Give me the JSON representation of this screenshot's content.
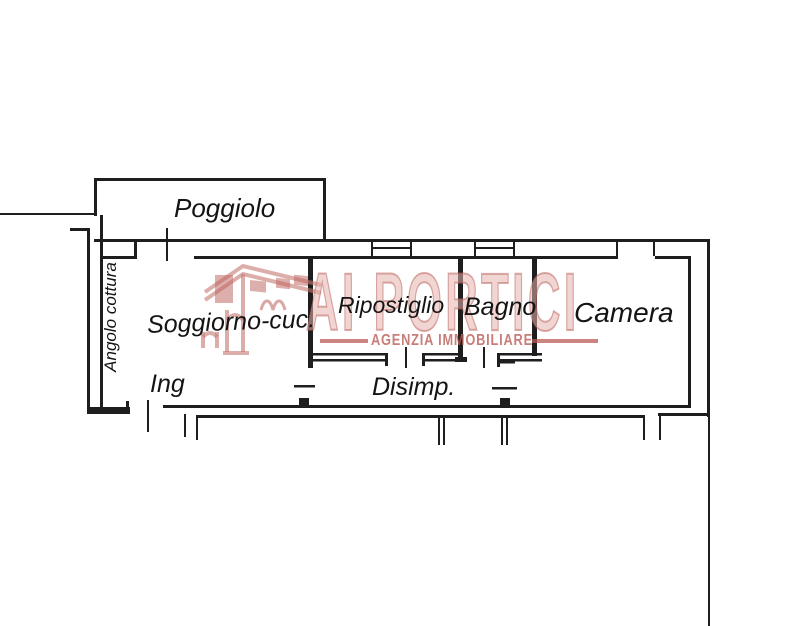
{
  "rooms": {
    "poggiolo": "Poggiolo",
    "angolo_cottura": "Angolo cottura",
    "soggiorno": "Soggiorno-cuc.",
    "ripostiglio": "Ripostiglio",
    "bagno": "Bagno",
    "camera": "Camera",
    "ingresso": "Ing",
    "disimpegno": "Disimp."
  },
  "watermark": {
    "brand": "AI PORTICI",
    "tagline": "AGENZIA IMMOBILIARE",
    "accent_color": "#ba5c56",
    "fill_color": "#e4b2ad"
  },
  "colors": {
    "line": "#1e1e1e",
    "background": "#ffffff"
  }
}
